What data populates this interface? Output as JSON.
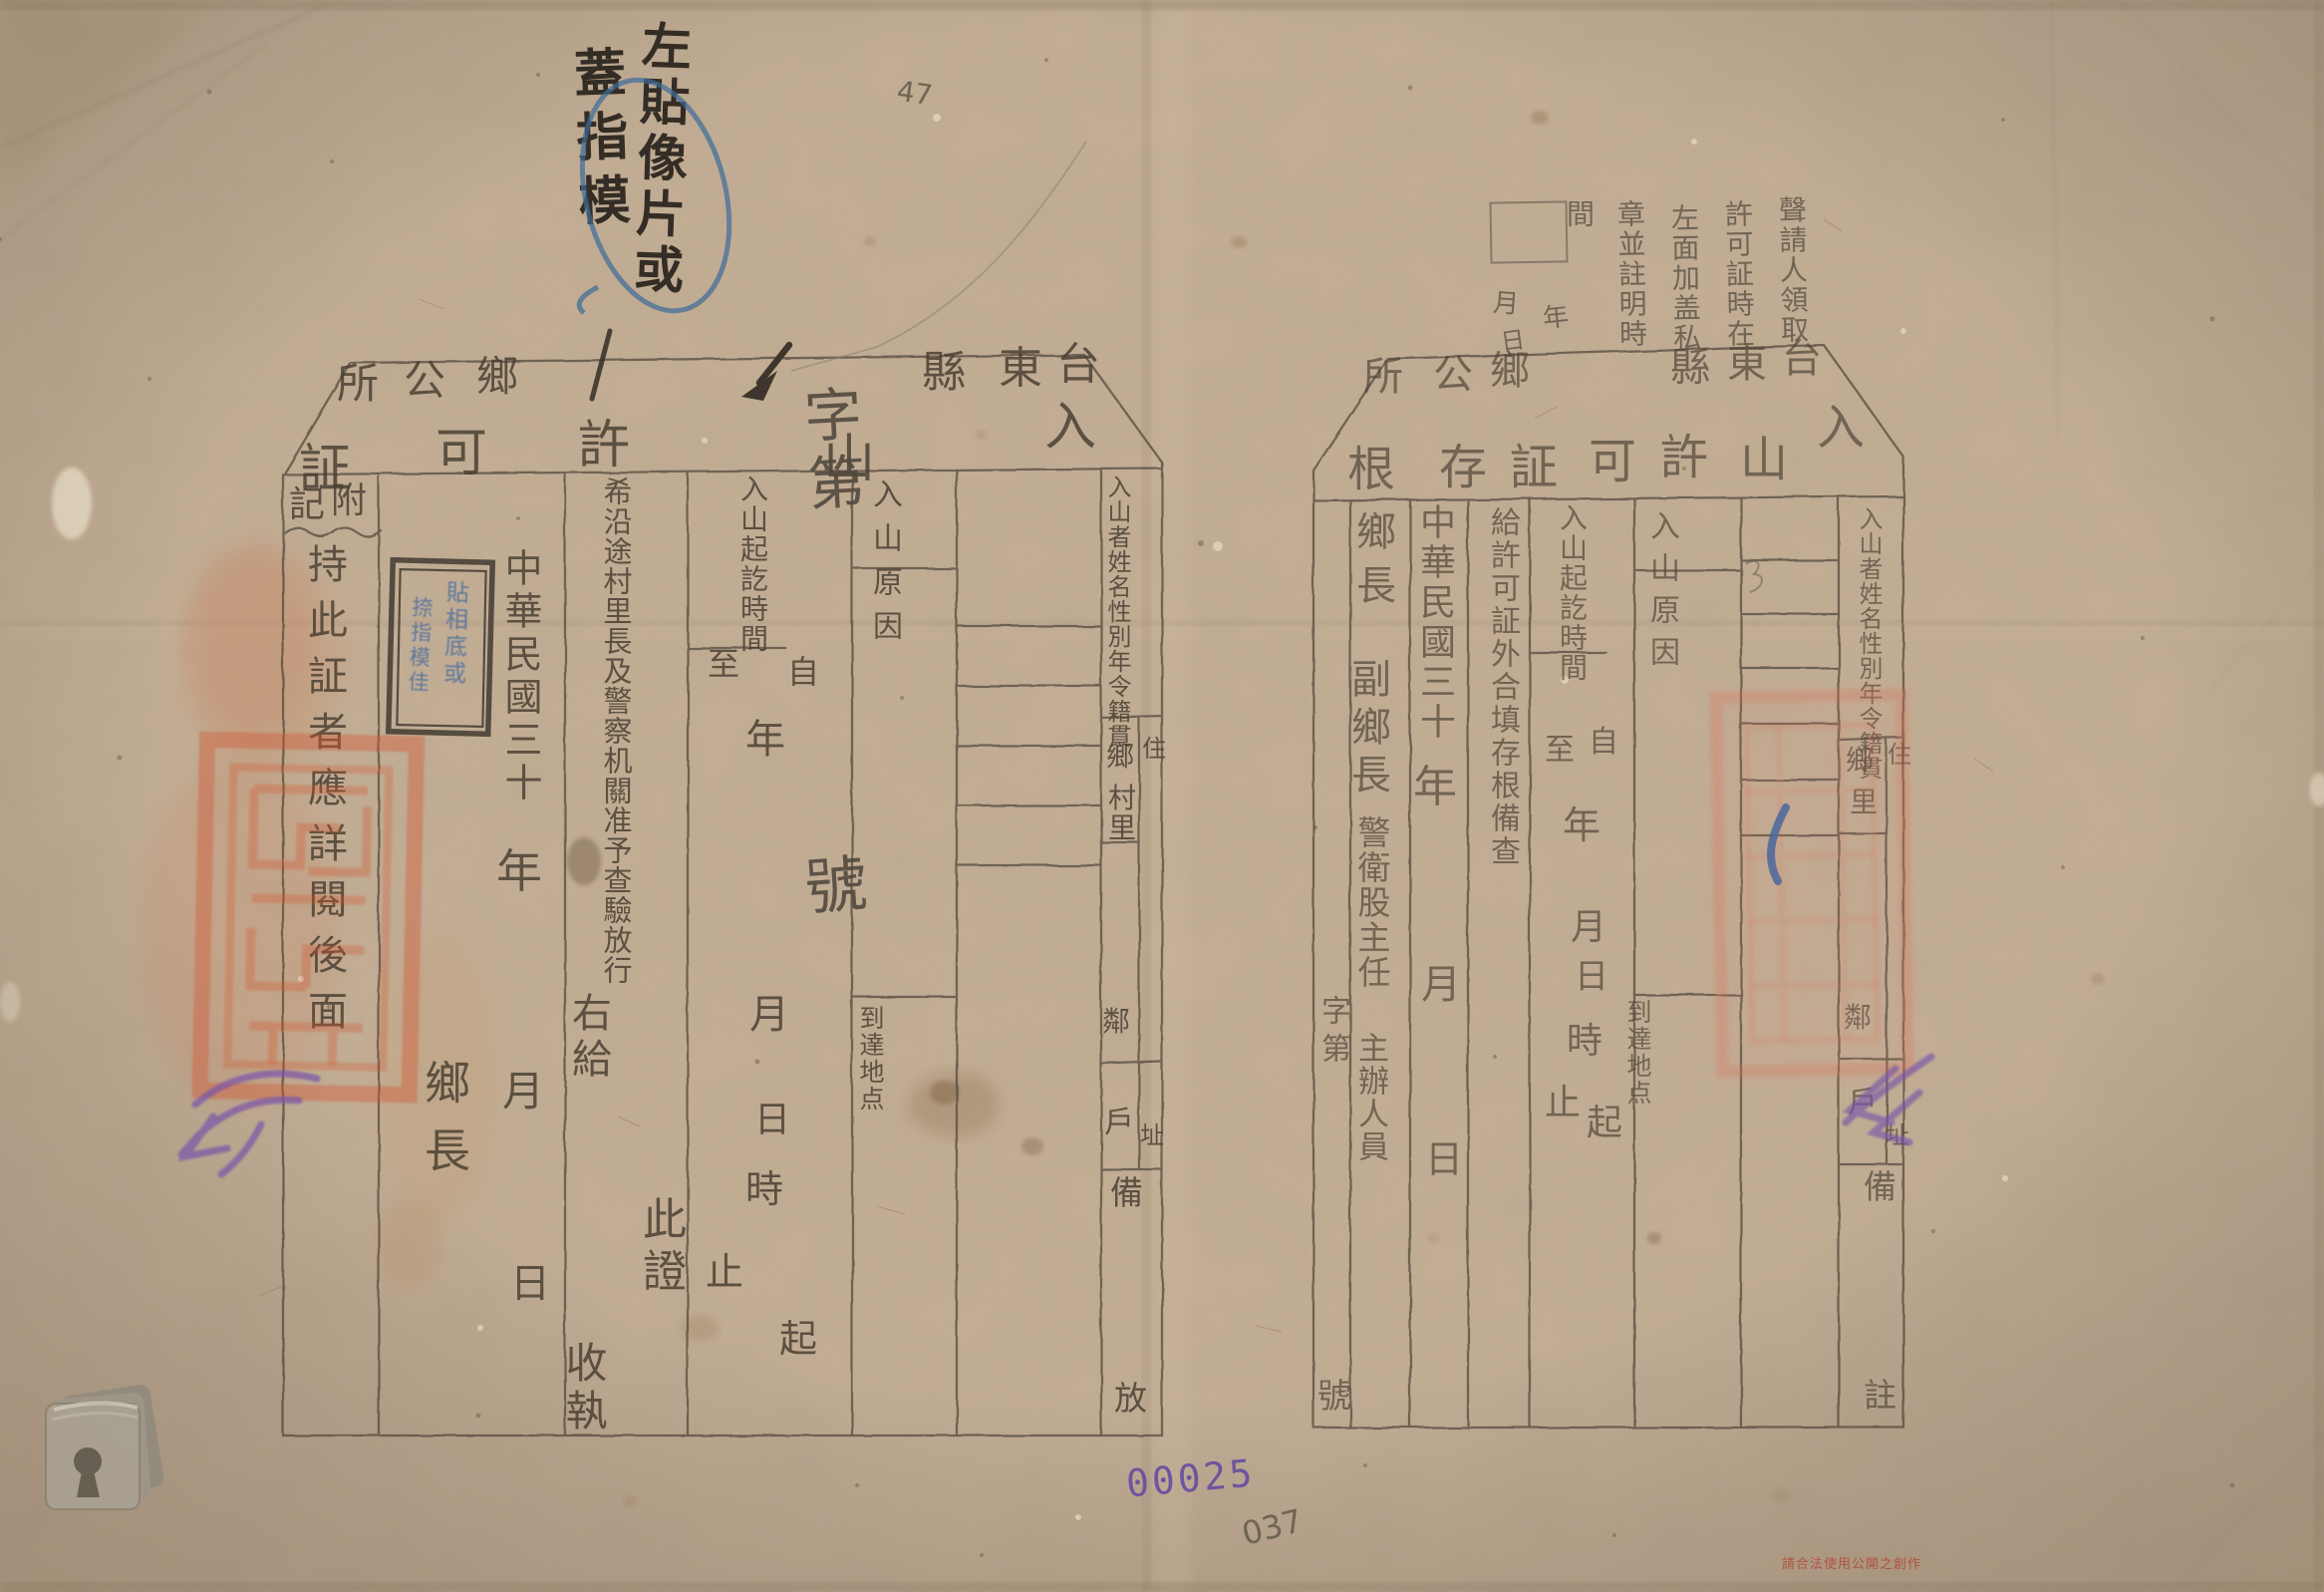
{
  "left_form": {
    "county_prefix": "台東縣",
    "office_suffix": "鄉公所",
    "title": "入山許可証",
    "name_column_label": "入山者姓名性別年令籍貫",
    "residence_top": "住",
    "residence_bottom": "址",
    "addr_unit_1": "鄉",
    "addr_unit_2": "村",
    "addr_unit_3": "里",
    "addr_unit_4": "鄰",
    "addr_unit_5": "戶",
    "remark_top": "備",
    "remark_bottom": "放",
    "reason_label": "入山原因",
    "destination_label": "到達地点",
    "period_label": "入山起訖時間",
    "from_marker": "自",
    "to_marker": "至",
    "unit_year": "年",
    "unit_month": "月",
    "unit_day": "日",
    "unit_hour": "時",
    "start_suffix": "起",
    "end_suffix": "止",
    "request_clause": "希沿途村里長及警察机關准予查驗放行",
    "this_certificate": "此證",
    "issued_to": "右給",
    "receipt": "收執",
    "date_era": "中華民國三十",
    "date_year": "年",
    "date_month": "月",
    "date_day": "日",
    "signer": "鄉長",
    "appendix_label": "附記",
    "appendix_text": "持此証者應詳閱後面"
  },
  "right_form": {
    "county_prefix": "台東縣",
    "office_suffix": "鄉公所",
    "title": "入山許可証存根",
    "name_column_label": "入山者姓名性別年令籍貫",
    "residence_top": "住",
    "residence_bottom": "址",
    "addr_unit_1": "鄉",
    "addr_unit_2": "里",
    "addr_unit_3": "鄰",
    "addr_unit_4": "戶",
    "remark_top": "備",
    "remark_bottom": "註",
    "reason_label": "入山原因",
    "destination_label": "到達地点",
    "period_label": "入山起訖時間",
    "from_marker": "自",
    "to_marker": "至",
    "unit_year": "年",
    "unit_month": "月",
    "unit_day": "日",
    "unit_hour": "時",
    "start_suffix": "起",
    "end_suffix": "止",
    "stub_clause": "給許可証外合填存根備查",
    "date_era": "中華民國三十",
    "date_year": "年",
    "date_month": "月",
    "date_day": "日",
    "signer_1": "鄉長",
    "signer_2": "副鄉長",
    "signer_3": "警衛股主任",
    "signer_4": "主辦人員",
    "ref_prefix": "字第",
    "ref_suffix": "號"
  },
  "annotations": {
    "photo_note_line_1": "左貼像片或",
    "photo_note_line_2": "蓋指模",
    "stamp_box_blue_1": "貼相底或",
    "stamp_box_blue_2": "捺指模佳",
    "claim_note_col_1": "聲請人領取",
    "claim_note_col_2": "許可証時在",
    "claim_note_col_3": "左面加盖私",
    "claim_note_col_4": "章並註明時",
    "claim_note_col_5": "間",
    "pencil_year": "年",
    "pencil_month": "月",
    "pencil_day": "日",
    "big_ref_prefix": "字第",
    "big_ref_suffix": "號",
    "serial_number": "00025",
    "pencil_number": "037",
    "pencil_mark": "47",
    "footer_red_text": "請合法使用公開之創作"
  },
  "colors": {
    "paper": "#c6b097",
    "ink": "#4a4034",
    "seal_red": "#d84e28",
    "purple": "#7550ae",
    "serial_purple": "#5b3fa5",
    "blue": "#34689c",
    "pencil_grey": "#6b6154"
  }
}
